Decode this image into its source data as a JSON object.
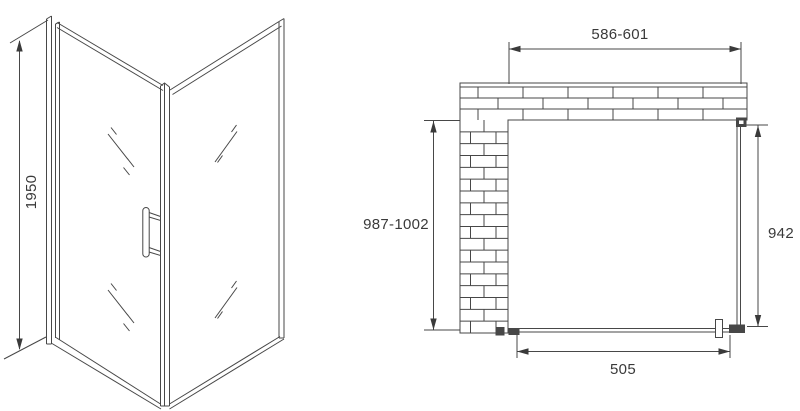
{
  "side_view": {
    "height_label": "1950"
  },
  "top_view": {
    "width_label": "586-601",
    "depth_label": "987-1002",
    "panel_label": "942",
    "door_label": "505"
  },
  "style": {
    "line_color": "#474747",
    "text_color": "#3a3a3a",
    "background": "#ffffff"
  }
}
